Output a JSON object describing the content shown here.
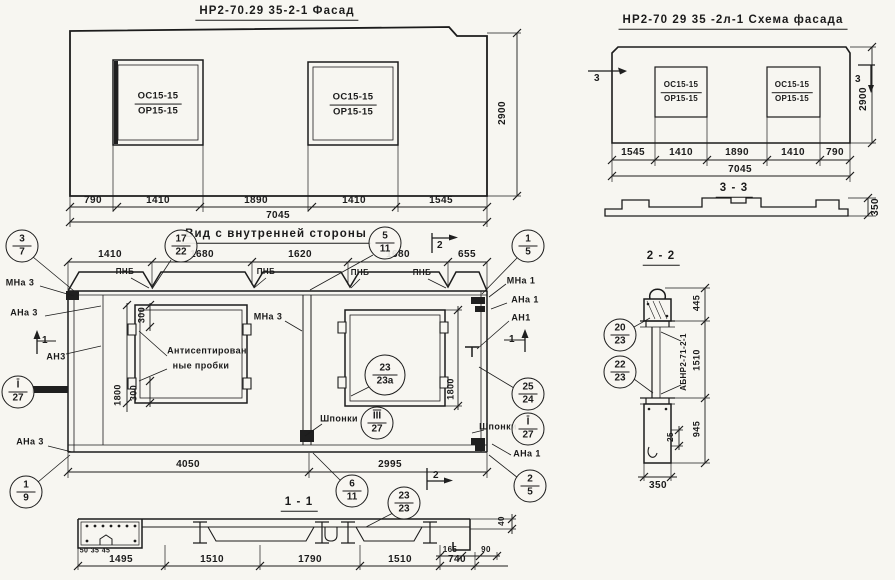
{
  "facade": {
    "title": "НР2-70.29 35-2-1 Фасад",
    "opening_label_top": "ОС15-15",
    "opening_label_bottom": "ОР15-15",
    "dims_bottom": [
      "790",
      "1410",
      "1890",
      "1410",
      "1545"
    ],
    "dim_total": "7045",
    "dim_height": "2900"
  },
  "schema": {
    "title": "НР2-70 29 35 -2л-1 Схема фасада",
    "opening_label_top": "ОС15-15",
    "opening_label_bottom": "ОР15-15",
    "dims_bottom": [
      "1545",
      "1410",
      "1890",
      "1410",
      "790"
    ],
    "dim_total": "7045",
    "dim_height": "2900",
    "cut_marker": "3",
    "section_title": "3 - 3",
    "section_thickness": "350"
  },
  "inner": {
    "title": "Вид с внутренней стороны",
    "dims_top": [
      "1410",
      "1680",
      "1620",
      "1680",
      "655"
    ],
    "dims_bottom": [
      "4050",
      "2995"
    ],
    "dim_300": "300",
    "dim_1800": "1800",
    "rib_label": "ПНБ",
    "note_line1": "Антисептирован",
    "note_line2": "ные пробки",
    "keys_label": "Шпонки",
    "cut_1": "1",
    "cut_2": "2",
    "anchors": {
      "mna3": "МНа 3",
      "ana3": "АНа 3",
      "an3": "АН3",
      "mna1": "МНа 1",
      "ana1": "АНа 1",
      "an1": "АН1"
    },
    "callouts": {
      "c3_7": {
        "top": "3",
        "bottom": "7"
      },
      "c17_22": {
        "top": "17",
        "bottom": "22"
      },
      "c5_11": {
        "top": "5",
        "bottom": "11"
      },
      "c1_5": {
        "top": "1",
        "bottom": "5"
      },
      "c1_9": {
        "top": "1",
        "bottom": "9"
      },
      "cI_27_left": {
        "top": "I",
        "bottom": "27"
      },
      "cIII_27": {
        "top": "III",
        "bottom": "27"
      },
      "cI_27_right": {
        "top": "I",
        "bottom": "27"
      },
      "c25_24": {
        "top": "25",
        "bottom": "24"
      },
      "c23_23a": {
        "top": "23",
        "bottom": "23а"
      },
      "c6_11": {
        "top": "6",
        "bottom": "11"
      },
      "c23_23": {
        "top": "23",
        "bottom": "23"
      },
      "c2_5": {
        "top": "2",
        "bottom": "5"
      }
    }
  },
  "section_1_1": {
    "title": "1 - 1",
    "dims_bottom": [
      "1495",
      "1510",
      "1790",
      "1510",
      "740"
    ],
    "dims_small_left": [
      "50",
      "35",
      "45"
    ],
    "dims_small_right": [
      "165",
      "90"
    ],
    "dim_edge": "40"
  },
  "section_2_2": {
    "title": "2 - 2",
    "stamp": "АБНР2-71-2-1",
    "dims_right": [
      "445",
      "1510",
      "945"
    ],
    "dim_gap": "25",
    "dim_width": "350",
    "callouts": {
      "c20_23": {
        "top": "20",
        "bottom": "23"
      },
      "c22_23": {
        "top": "22",
        "bottom": "23"
      }
    }
  }
}
